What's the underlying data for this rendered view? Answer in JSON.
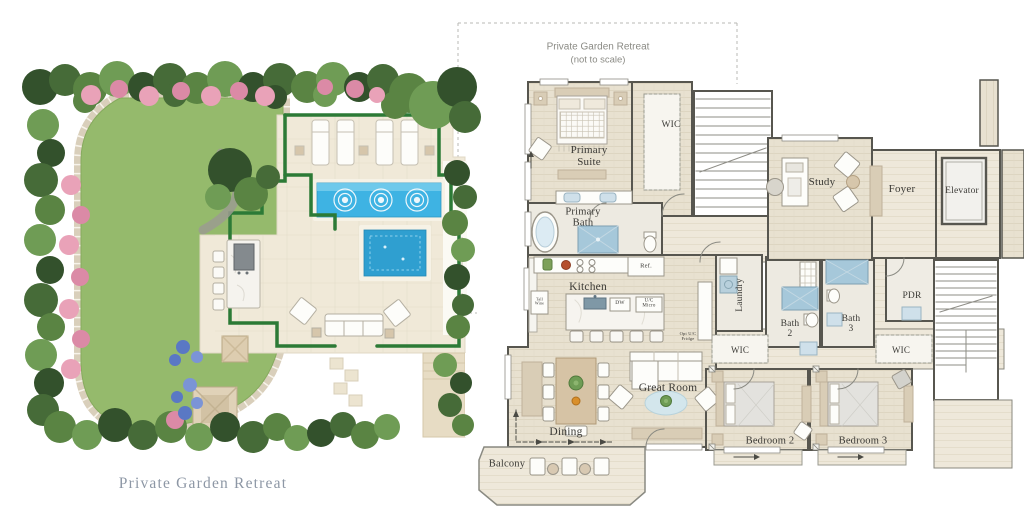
{
  "window": {
    "width": 1024,
    "height": 523,
    "background": "#ffffff"
  },
  "garden": {
    "caption": "Private Garden Retreat"
  },
  "callout": {
    "title": "Private Garden Retreat",
    "subtitle": "(not to scale)"
  },
  "floorplan": {
    "labels": {
      "primary_suite": "Primary Suite",
      "wic_primary": "WIC",
      "primary_bath": "Primary Bath",
      "kitchen": "Kitchen",
      "ref": "Ref.",
      "tall_wine": "Tall Wine",
      "dw": "DW",
      "uc_micro": "U/C Micro",
      "opt_uc_fridge": "Opt U/C Fridge",
      "dining": "Dining",
      "great_room": "Great Room",
      "balcony": "Balcony",
      "laundry": "Laundry",
      "bath_2": "Bath 2",
      "bath_3": "Bath 3",
      "wic_2": "WIC",
      "wic_3": "WIC",
      "pdr": "PDR",
      "bedroom_2": "Bedroom 2",
      "bedroom_3": "Bedroom 3",
      "study": "Study",
      "foyer": "Foyer",
      "elevator": "Elevator"
    }
  },
  "colors": {
    "hedge": "#2c7a36",
    "lawn": "#95ba6c",
    "pool": "#3eb3e3",
    "spa": "#2f9fd0",
    "patio": "#f0e9d8",
    "floor": "#e8e1d0",
    "wall": "#57564f",
    "shower_tile": "#a6c8da",
    "flower_pink": "#e9a2b8",
    "flower_blue": "#5a78c4",
    "label_ink": "#3b3a36",
    "caption_ink": "#8d97a5",
    "callout_ink": "#8b8b85"
  }
}
